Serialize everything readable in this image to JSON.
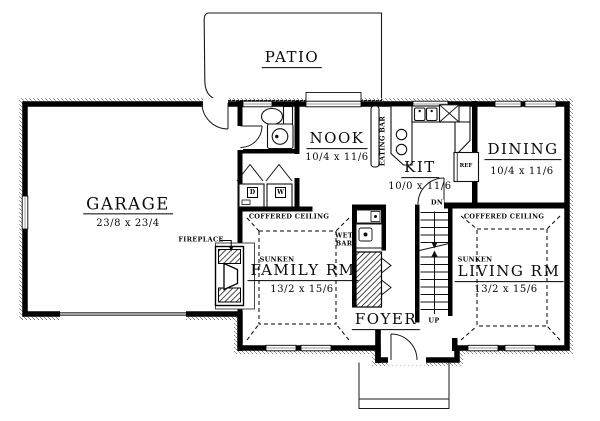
{
  "rooms": {
    "patio": {
      "label": "PATIO"
    },
    "garage": {
      "label": "GARAGE",
      "dims": "23/8 x 23/4"
    },
    "nook": {
      "label": "NOOK",
      "dims": "10/4 x 11/6"
    },
    "kitchen": {
      "label": "KIT",
      "dims": "10/0 x 11/6"
    },
    "dining": {
      "label": "DINING",
      "dims": "10/4 x 11/6"
    },
    "family": {
      "label": "FAMILY RM",
      "dims": "13/2 x 15/6",
      "ceiling": "COFFERED CEILING",
      "floor": "SUNKEN"
    },
    "living": {
      "label": "LIVING RM",
      "dims": "13/2 x 15/6",
      "ceiling": "COFFERED CEILING",
      "floor": "SUNKEN"
    },
    "foyer": {
      "label": "FOYER"
    }
  },
  "annotations": {
    "fireplace": "FIREPLACE",
    "wet_bar": "WET BAR",
    "eating_bar": "EATING BAR",
    "refrigerator": "REF",
    "stairs_down": "DN",
    "stairs_up": "UP",
    "dryer": "D",
    "washer": "W"
  },
  "colors": {
    "wall": "#000000",
    "background": "#ffffff",
    "exterior_texture": "#9a9a9a"
  }
}
